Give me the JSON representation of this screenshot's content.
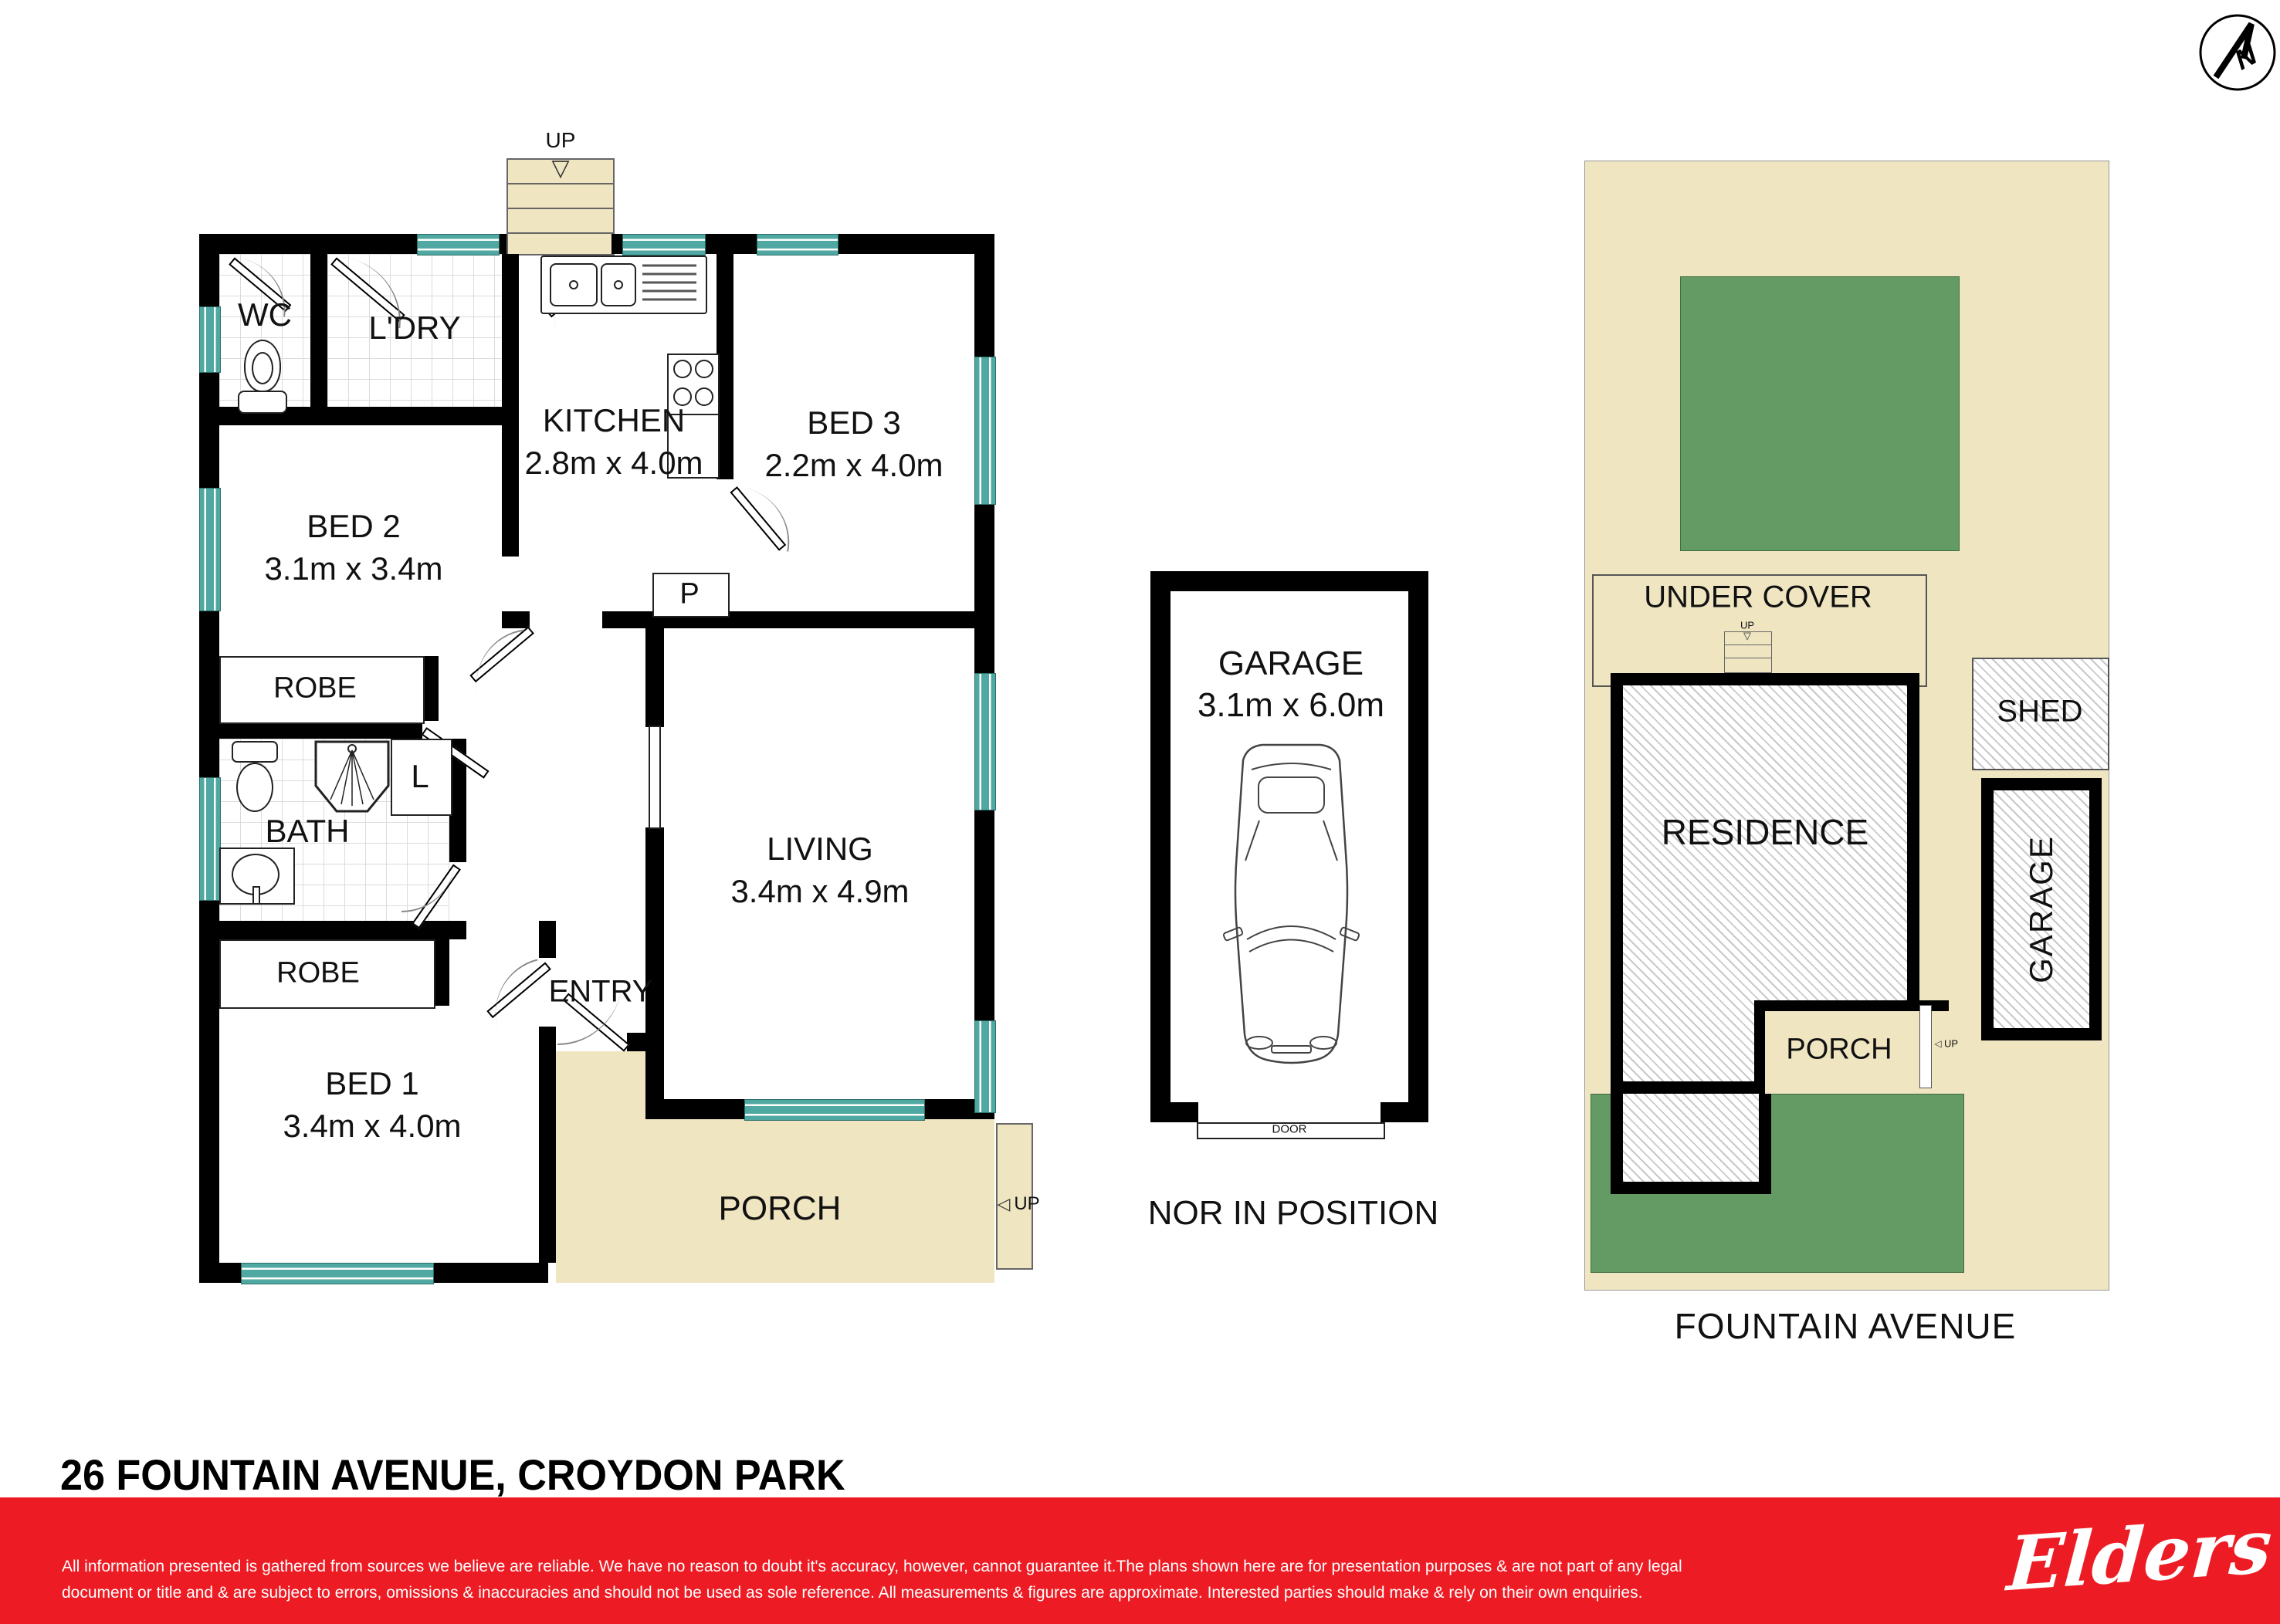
{
  "title": "26 FOUNTAIN AVENUE, CROYDON PARK",
  "compass": {
    "letter": "N"
  },
  "floorplan": {
    "back_stairs_up": "UP",
    "porch_up": "UP",
    "rooms": [
      {
        "id": "wc",
        "label": "WC"
      },
      {
        "id": "ldry",
        "label": "L'DRY"
      },
      {
        "id": "kitchen",
        "label": "KITCHEN",
        "dims": "2.8m x 4.0m"
      },
      {
        "id": "bed3",
        "label": "BED 3",
        "dims": "2.2m x 4.0m"
      },
      {
        "id": "bed2",
        "label": "BED 2",
        "dims": "3.1m x 3.4m"
      },
      {
        "id": "robe1",
        "label": "ROBE"
      },
      {
        "id": "bath",
        "label": "BATH"
      },
      {
        "id": "linen",
        "label": "L"
      },
      {
        "id": "pantry",
        "label": "P"
      },
      {
        "id": "robe2",
        "label": "ROBE"
      },
      {
        "id": "bed1",
        "label": "BED 1",
        "dims": "3.4m x 4.0m"
      },
      {
        "id": "entry",
        "label": "ENTRY"
      },
      {
        "id": "living",
        "label": "LIVING",
        "dims": "3.4m x 4.9m"
      },
      {
        "id": "porch",
        "label": "PORCH"
      }
    ]
  },
  "garage_plan": {
    "label": "GARAGE",
    "dims": "3.1m x 6.0m",
    "door_label": "DOOR",
    "caption": "NOR IN POSITION"
  },
  "site_plan": {
    "under_cover": "UNDER COVER",
    "under_cover_up": "UP",
    "residence": "RESIDENCE",
    "shed": "SHED",
    "garage": "GARAGE",
    "porch": "PORCH",
    "porch_up": "UP",
    "street": "FOUNTAIN AVENUE"
  },
  "footer": {
    "disclaimer_line1": "All information presented is gathered from sources we believe are reliable. We have no reason to doubt it's accuracy, however, cannot guarantee it.The plans shown here are for presentation purposes & are not part of any legal",
    "disclaimer_line2": "document or title and & are subject to errors, omissions & inaccuracies and should not be used as sole reference. All measurements & figures are approximate. Interested parties should make & rely on their own enquiries.",
    "logo": "Elders"
  },
  "colors": {
    "wall_black": "#000000",
    "window_teal": "#4fa8a1",
    "porch_tan": "#efe5c1",
    "lawn_green": "#649a64",
    "footer_red": "#ed1c24"
  }
}
